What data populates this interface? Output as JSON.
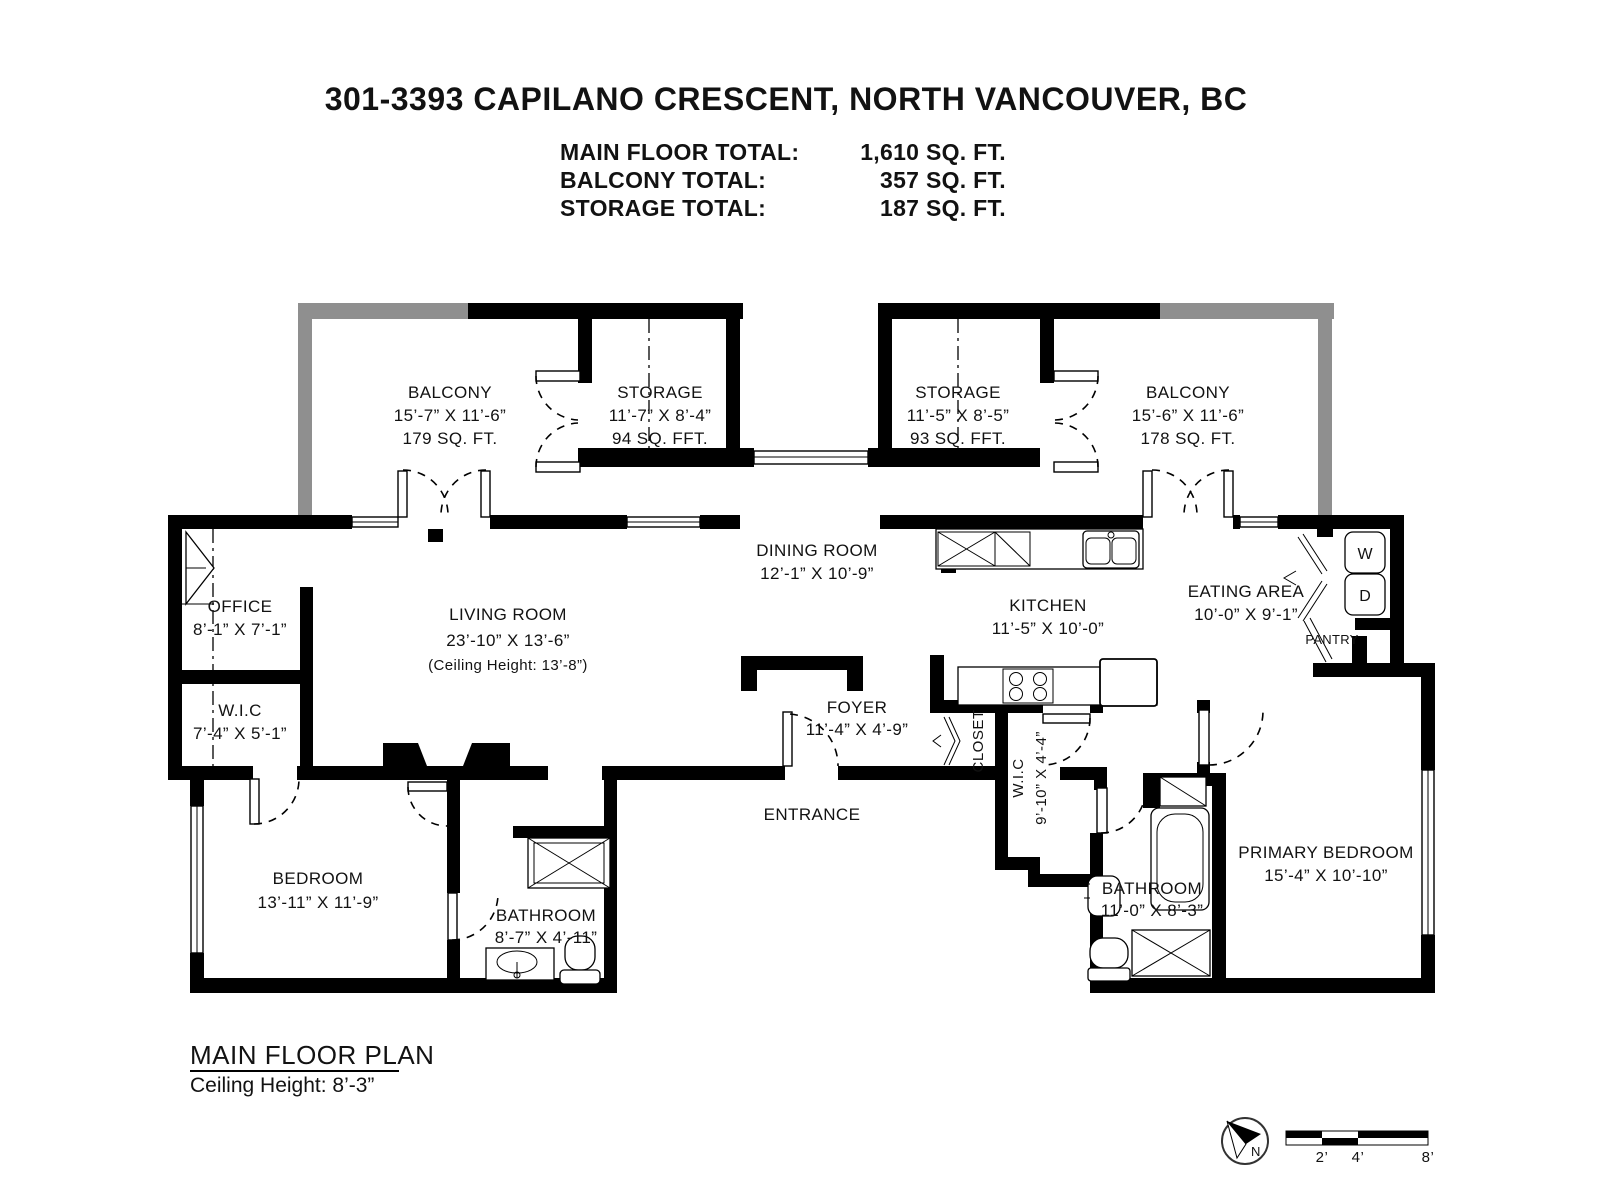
{
  "header": {
    "title": "301-3393 CAPILANO CRESCENT, NORTH VANCOUVER, BC",
    "totals": [
      {
        "label": "MAIN FLOOR TOTAL:",
        "value": "1,610 SQ. FT."
      },
      {
        "label": "BALCONY TOTAL:",
        "value": "357 SQ. FT."
      },
      {
        "label": "STORAGE TOTAL:",
        "value": "187 SQ. FT."
      }
    ]
  },
  "plan": {
    "balcony_left": {
      "name": "BALCONY",
      "dims": "15’-7” X 11’-6”",
      "area": "179 SQ. FT."
    },
    "storage_left": {
      "name": "STORAGE",
      "dims": "11’-7” X 8’-4”",
      "area": "94 SQ. FFT."
    },
    "storage_right": {
      "name": "STORAGE",
      "dims": "11’-5” X 8’-5”",
      "area": "93 SQ. FFT."
    },
    "balcony_right": {
      "name": "BALCONY",
      "dims": "15’-6” X 11’-6”",
      "area": "178 SQ. FT."
    },
    "dining_room": {
      "name": "DINING ROOM",
      "dims": "12’-1” X 10’-9”"
    },
    "living_room": {
      "name": "LIVING ROOM",
      "dims": "23’-10” X 13’-6”",
      "note": "(Ceiling Height: 13’-8”)"
    },
    "office": {
      "name": "OFFICE",
      "dims": "8’-1” X 7’-1”"
    },
    "wic_left": {
      "name": "W.I.C",
      "dims": "7’-4” X 5’-1”"
    },
    "kitchen": {
      "name": "KITCHEN",
      "dims": "11’-5” X 10’-0”"
    },
    "eating_area": {
      "name": "EATING AREA",
      "dims": "10’-0” X 9’-1”"
    },
    "foyer": {
      "name": "FOYER",
      "dims": "11’-4” X 4’-9”"
    },
    "entrance_label": "ENTRANCE",
    "closet_label": "CLOSET",
    "pantry_label": "PANTRY",
    "wic_right": {
      "name": "W.I.C",
      "dims": "9’-10” X 4’-4”"
    },
    "bedroom": {
      "name": "BEDROOM",
      "dims": "13’-11” X 11’-9”"
    },
    "bathroom_left": {
      "name": "BATHROOM",
      "dims": "8’-7” X 4’-11”"
    },
    "bathroom_right": {
      "name": "BATHROOM",
      "dims": "11’-0” X 8’-3”"
    },
    "primary_bedroom": {
      "name": "PRIMARY BEDROOM",
      "dims": "15’-4” X 10’-10”"
    },
    "washer_label": "W",
    "dryer_label": "D"
  },
  "footer": {
    "plan_name": "MAIN FLOOR PLAN",
    "ceiling_note": "Ceiling Height: 8’-3”"
  },
  "compass": {
    "north_label": "N"
  },
  "scale_bar": {
    "ticks": [
      "2’",
      "4’",
      "8’"
    ]
  }
}
